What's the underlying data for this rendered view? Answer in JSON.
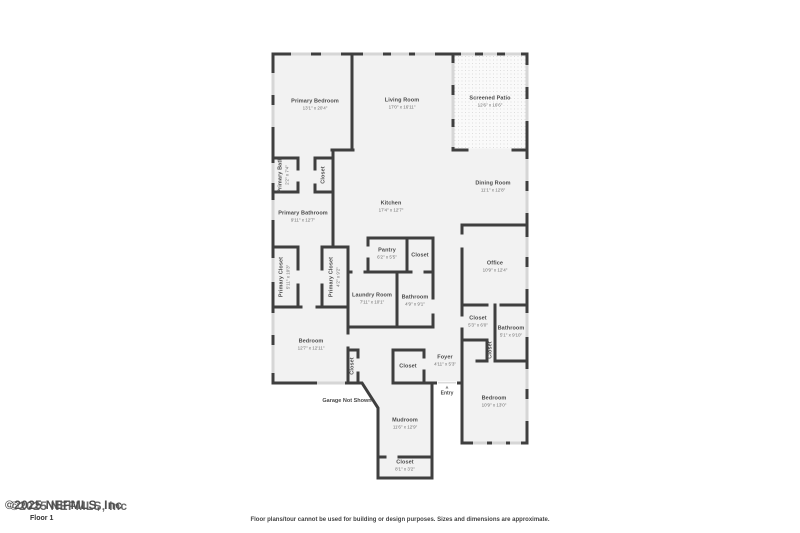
{
  "watermark": {
    "line1": "©2025 NEFMLS, Inc",
    "line2": "©2025 NEFMLS, Inc",
    "floor_label": "Floor 1"
  },
  "footer": {
    "disclaimer": "Floor plans/tour cannot be used for building or design purposes. Sizes and dimensions are approximate."
  },
  "plan": {
    "colors": {
      "wall": "#3f3f3f",
      "room_fill": "#f2f2f2",
      "window": "#d6d6d6",
      "label_text": "#4a4a4a"
    },
    "annotations": {
      "garage_note": "Garage Not Shown",
      "entry_label": "Entry",
      "entry_arrow": "▲"
    },
    "rooms": [
      {
        "name": "Primary Bedroom",
        "dims": "13'1\" x 20'4\""
      },
      {
        "name": "Living Room",
        "dims": "17'0\" x 16'11\""
      },
      {
        "name": "Screened Patio",
        "dims": "12'6\" x 16'6\""
      },
      {
        "name": "Dining Room",
        "dims": "11'1\" x 12'8\""
      },
      {
        "name": "Primary Bath",
        "dims": "2'2\" x 7'4\""
      },
      {
        "name": "Closet",
        "dims": ""
      },
      {
        "name": "Primary Bathroom",
        "dims": "9'11\" x 12'7\""
      },
      {
        "name": "Kitchen",
        "dims": "17'4\" x 12'7\""
      },
      {
        "name": "Primary Closet",
        "dims": "5'11\" x 10'3\""
      },
      {
        "name": "Primary Closet",
        "dims": "4'2\" x 9'2\""
      },
      {
        "name": "Pantry",
        "dims": "6'2\" x 5'5\""
      },
      {
        "name": "Closet",
        "dims": ""
      },
      {
        "name": "Office",
        "dims": "10'9\" x 12'4\""
      },
      {
        "name": "Laundry Room",
        "dims": "7'11\" x 10'1\""
      },
      {
        "name": "Bathroom",
        "dims": "4'9\" x 9'1\""
      },
      {
        "name": "Closet",
        "dims": "5'3\" x 6'0\""
      },
      {
        "name": "Bathroom",
        "dims": "5'1\" x 9'10\""
      },
      {
        "name": "Closet",
        "dims": ""
      },
      {
        "name": "Bedroom",
        "dims": "12'7\" x 12'11\""
      },
      {
        "name": "Closet",
        "dims": ""
      },
      {
        "name": "Closet",
        "dims": ""
      },
      {
        "name": "Foyer",
        "dims": "4'11\" x 5'3\""
      },
      {
        "name": "Bedroom",
        "dims": "10'9\" x 13'0\""
      },
      {
        "name": "Mudroom",
        "dims": "11'6\" x 12'9\""
      },
      {
        "name": "Closet",
        "dims": "8'1\" x 3'2\""
      }
    ]
  }
}
